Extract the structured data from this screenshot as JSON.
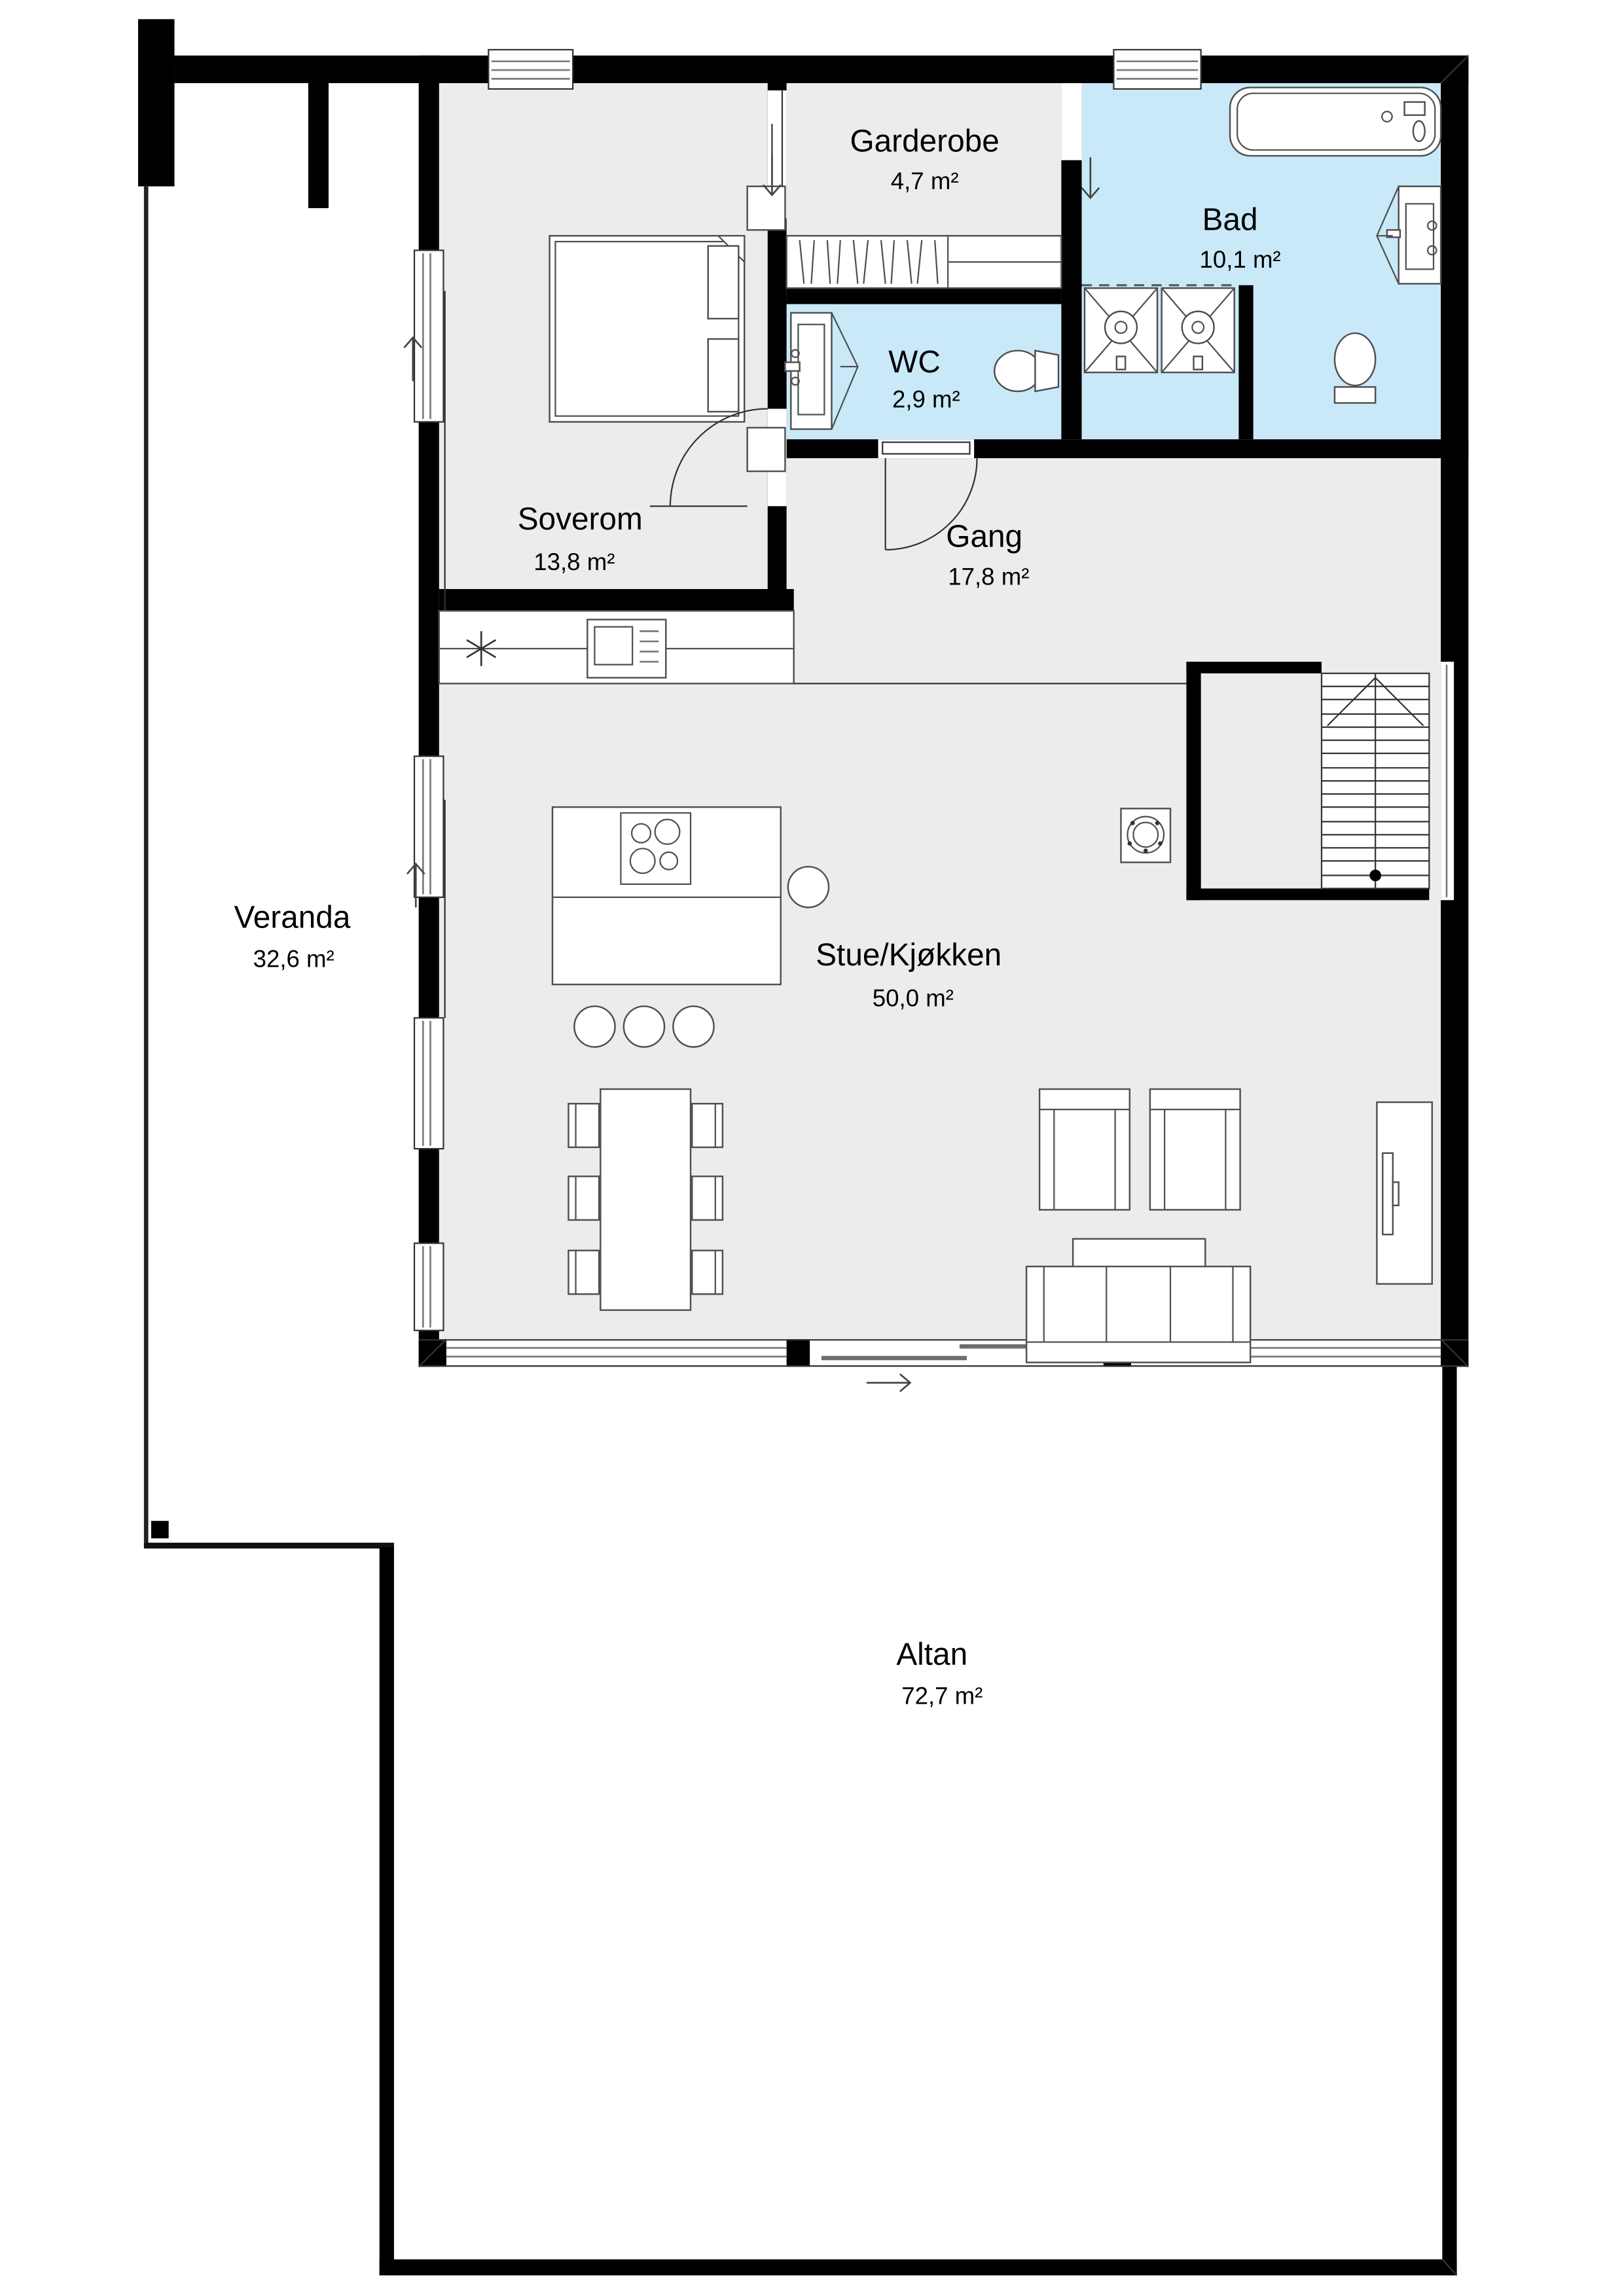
{
  "plan_title": "Floor plan",
  "rooms": {
    "soverom": {
      "name": "Soverom",
      "area": "13,8 m²"
    },
    "garderobe": {
      "name": "Garderobe",
      "area": "4,7 m²"
    },
    "bad": {
      "name": "Bad",
      "area": "10,1 m²"
    },
    "wc": {
      "name": "WC",
      "area": "2,9 m²"
    },
    "gang": {
      "name": "Gang",
      "area": "17,8 m²"
    },
    "stue_kjokken": {
      "name": "Stue/Kjøkken",
      "area": "50,0 m²"
    },
    "veranda": {
      "name": "Veranda",
      "area": "32,6 m²"
    },
    "altan": {
      "name": "Altan",
      "area": "72,7 m²"
    }
  },
  "colors": {
    "wall": "#000000",
    "floor_interior": "#ececec",
    "floor_wetroom": "#c9e9f8",
    "floor_outdoor": "#ffffff",
    "furniture_outline": "#4f4f4f",
    "text": "#000000"
  },
  "icons": {
    "entry-arrow-down": "↓",
    "entry-arrow-up": "↑",
    "entry-arrow-right": "→",
    "stair-direction": "triangle-up + center line + start dot",
    "kitchen-sink": "asterisk",
    "fireplace": "square with ring"
  }
}
